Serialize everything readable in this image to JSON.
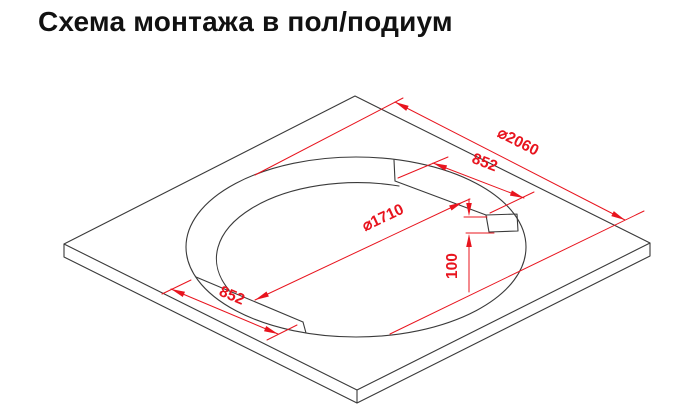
{
  "title": "Схема монтажа в пол/подиум",
  "diagram": {
    "type": "isometric installation drawing of square podium with round bathtub cutout",
    "labels": {
      "outer_diameter": "⌀2060",
      "inner_diameter": "⌀1710",
      "ledge_width_top": "852",
      "ledge_width_bottom": "852",
      "ledge_depth": "100"
    },
    "colors": {
      "dimension_red": "#e8141e",
      "outline_black": "#3a3a3a",
      "background": "#ffffff",
      "title_black": "#111111"
    }
  }
}
